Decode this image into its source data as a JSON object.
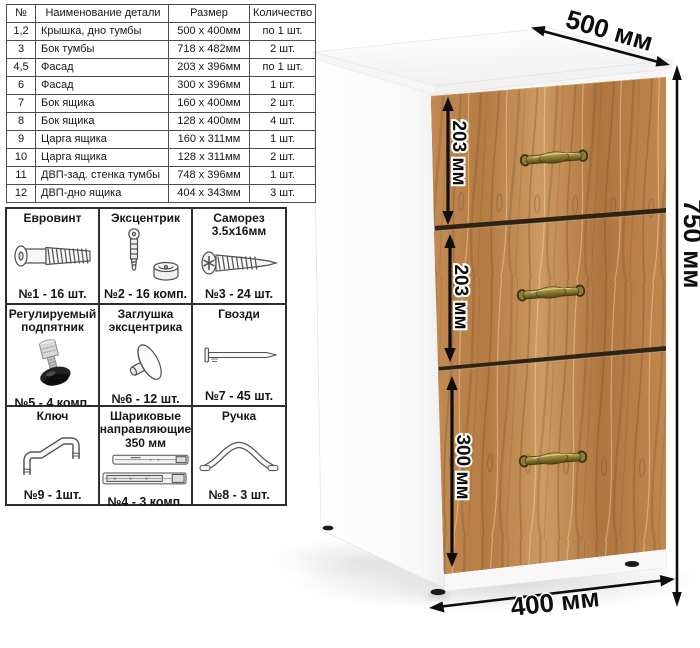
{
  "parts_table": {
    "headers": [
      "№",
      "Наименование детали",
      "Размер",
      "Количество"
    ],
    "rows": [
      [
        "1,2",
        "Крышка, дно тумбы",
        "500 x 400мм",
        "по 1 шт."
      ],
      [
        "3",
        "Бок тумбы",
        "718 x 482мм",
        "2 шт."
      ],
      [
        "4,5",
        "Фасад",
        "203 x 396мм",
        "по 1 шт."
      ],
      [
        "6",
        "Фасад",
        "300 x 396мм",
        "1 шт."
      ],
      [
        "7",
        "Бок ящика",
        "160 x 400мм",
        "2 шт."
      ],
      [
        "8",
        "Бок ящика",
        "128 x 400мм",
        "4 шт."
      ],
      [
        "9",
        "Царга ящика",
        "160 x 311мм",
        "1 шт."
      ],
      [
        "10",
        "Царга ящика",
        "128 x 311мм",
        "2 шт."
      ],
      [
        "11",
        "ДВП-зад. стенка тумбы",
        "748 x 396мм",
        "1 шт."
      ],
      [
        "12",
        "ДВП-дно ящика",
        "404 x 343мм",
        "3 шт."
      ]
    ]
  },
  "hardware": {
    "items": [
      {
        "name": "Евровинт",
        "icon": "euroscrew-icon",
        "count": "№1 - 16 шт."
      },
      {
        "name": "Эксцентрик",
        "icon": "eccentric-cam-icon",
        "count": "№2 - 16 комп."
      },
      {
        "name": "Саморез 3.5х16мм",
        "icon": "screw-icon",
        "count": "№3 - 24 шт."
      },
      {
        "name": "Регулируемый подпятник",
        "icon": "adjustable-foot-icon",
        "count": "№5 - 4 комп."
      },
      {
        "name": "Заглушка эксцентрика",
        "icon": "cam-cap-icon",
        "count": "№6 - 12 шт."
      },
      {
        "name": "Гвозди",
        "icon": "nail-icon",
        "count": "№7 - 45 шт."
      },
      {
        "name": "Ключ",
        "icon": "hex-key-icon",
        "count": "№9 - 1шт."
      },
      {
        "name": "Шариковые направляющие 350 мм",
        "icon": "ball-slides-icon",
        "count": "№4 - 3 комп."
      },
      {
        "name": "Ручка",
        "icon": "handle-icon",
        "count": "№8 - 3 шт."
      }
    ]
  },
  "cabinet": {
    "depth_label": "500 мм",
    "height_label": "750 мм",
    "width_label": "400 мм",
    "drawer_heights": [
      {
        "label": "203 мм"
      },
      {
        "label": "203 мм"
      },
      {
        "label": "300 мм"
      }
    ],
    "colors": {
      "wood": "#bf8750",
      "handle_brass": "#8a7a33",
      "dimension": "#0e0e0e",
      "body_white": "#fafafa"
    }
  }
}
